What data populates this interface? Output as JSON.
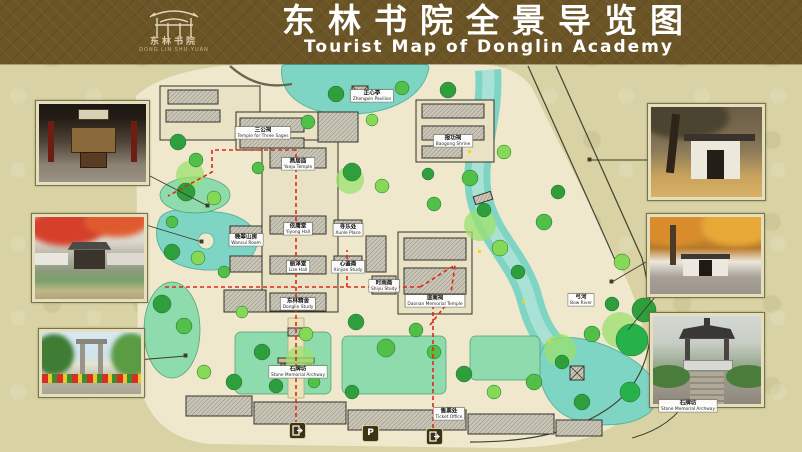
{
  "header": {
    "title_zh": "东林书院全景导览图",
    "title_en": "Tourist Map of Donglin Academy",
    "logo_zh": "东林书院",
    "logo_en": "DONG LIN SHU YUAN"
  },
  "map": {
    "parking_label": "P",
    "icons": {
      "entrance_exit": "door-with-arrow",
      "parking": "letter-P"
    },
    "route_color": "#e02818",
    "water_color": "#7ed5c4",
    "land_color": "#efe8cd",
    "labels": [
      {
        "zh": "三公祠",
        "en": "Temple for Three Sages"
      },
      {
        "zh": "燕居庙",
        "en": "Yanju Temple"
      },
      {
        "zh": "依庸堂",
        "en": "Yiyong Hall"
      },
      {
        "zh": "丽泽堂",
        "en": "Lize Hall"
      },
      {
        "zh": "东林精舍",
        "en": "Donglin Study"
      },
      {
        "zh": "石牌坊",
        "en": "Stone Memorial Archway"
      },
      {
        "zh": "道南祠",
        "en": "Daonan Memorial Temple"
      },
      {
        "zh": "报功祠",
        "en": "Baogong Shrine"
      },
      {
        "zh": "正心亭",
        "en": "Zhengxin Pavilion"
      },
      {
        "zh": "晚翠山房",
        "en": "Wancui Room"
      },
      {
        "zh": "时雨斋",
        "en": "Shiyu Study"
      },
      {
        "zh": "寻乐处",
        "en": "Xunle Place"
      },
      {
        "zh": "心鉴斋",
        "en": "Xinjian Study"
      },
      {
        "zh": "弓河",
        "en": "Bow River"
      },
      {
        "zh": "售票处",
        "en": "Ticket Office"
      },
      {
        "zh": "石牌坊",
        "en": "Stone Memorial Archway"
      }
    ]
  }
}
